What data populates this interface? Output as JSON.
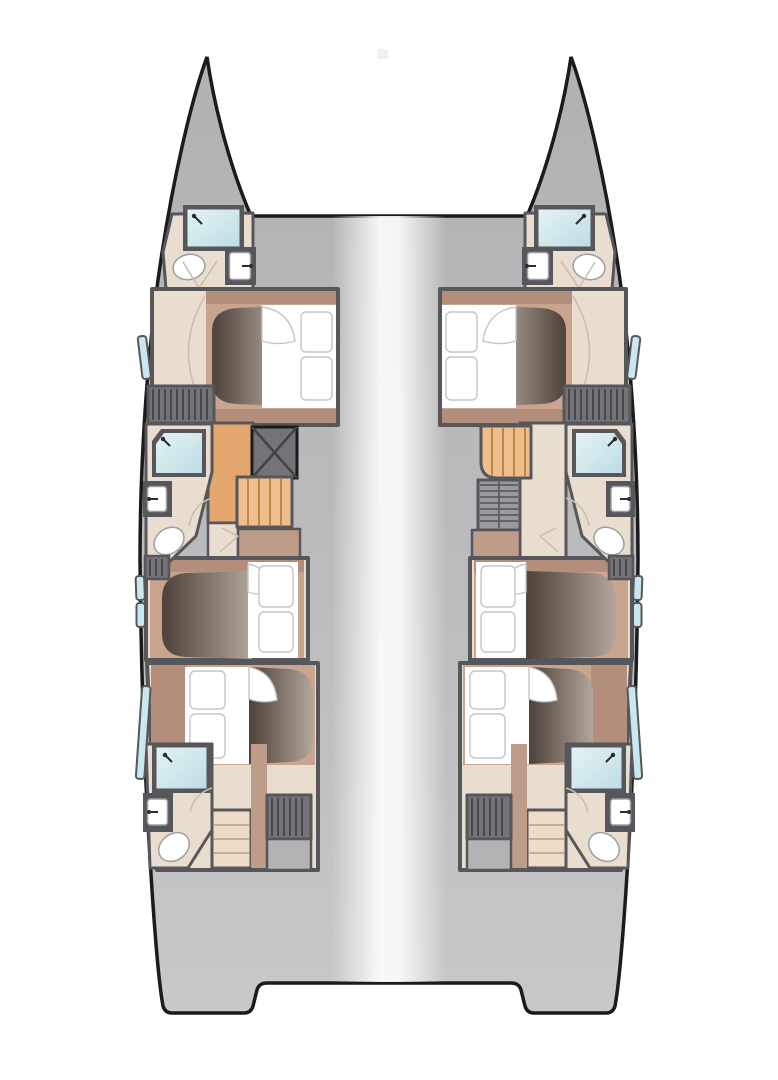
{
  "page": {
    "background": "#ffffff"
  },
  "plan": {
    "vessel": "catamaran",
    "view": "cabin-deck-top-view",
    "port_hull": {
      "cabins": 3,
      "double_berths": 3,
      "showers": 3,
      "toilets": 3,
      "sinks": 3,
      "hull_window_panes": 4,
      "wardrobe_lockers": 2,
      "companionway": "stairs with hatch",
      "aft_steps": 1,
      "engine_hatch": 1
    },
    "starboard_hull": {
      "cabins": 3,
      "double_berths": 3,
      "showers": 3,
      "toilets": 3,
      "sinks": 3,
      "hull_window_panes": 4,
      "wardrobe_lockers": 2,
      "companionway": "curved stairs with louvered hatch",
      "aft_steps": 1,
      "engine_hatch": 1
    },
    "bridge_deck": {
      "detail": "open deck with central highlight, stern cutout"
    }
  },
  "colors": {
    "outline": "#1b1b1d",
    "hull_top": "#b1b1b3",
    "hull_mid": "#bcbcbe",
    "hull_bottom": "#c8c8ca",
    "deck_highlight": "#fcfcfc",
    "wall": "#56565b",
    "floor": "#e9ddcf",
    "platform": "#c9a48e",
    "platform_dark": "#b28e7b",
    "tan_strip": "#bd9c8a",
    "mattress_dark": "#51453d",
    "mattress_light": "#b3a79c",
    "bedding": "#ffffff",
    "bedding_line": "#c5c5c5",
    "fixture_line": "#9aa0a5",
    "shower_light": "#e4f2f4",
    "shower_deep": "#bedde3",
    "window": "#c9e7ef",
    "stairs": "#e3a76e",
    "stairs_light": "#eebe8d",
    "stairs_line": "#c08648",
    "hatch": "#747478",
    "hatch_line": "#434347",
    "louver": "#9a9a9e",
    "louver_line": "#5c5c60",
    "steps": "#ecdcc8",
    "steps_line": "#c7ae92",
    "gray_box": "#b3b3b5",
    "faucet": "#2b2b2d",
    "door_line": "#cdbfae",
    "artifact": "#e9e9e9"
  }
}
